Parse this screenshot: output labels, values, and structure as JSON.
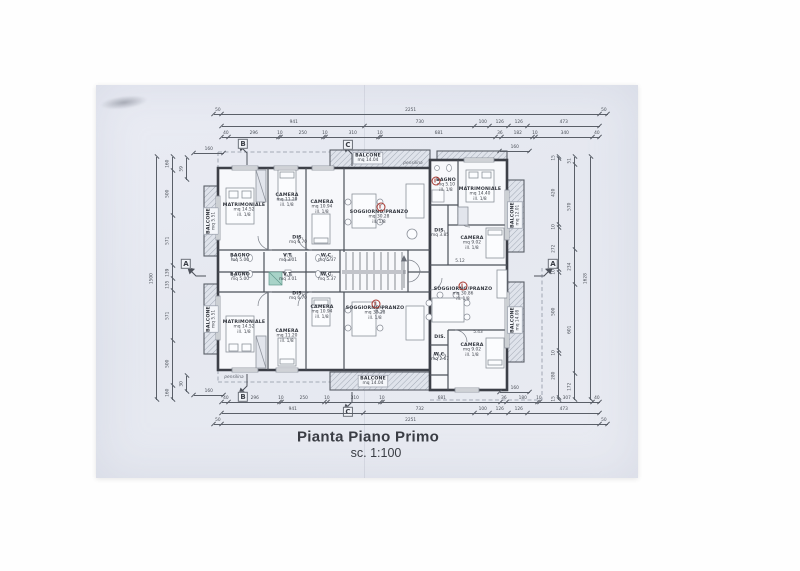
{
  "title": {
    "main": "Pianta Piano Primo",
    "scale": "sc. 1:100"
  },
  "sections": {
    "a": "A",
    "b": "B",
    "c": "C"
  },
  "annotations": {
    "pensilina": "pensilina"
  },
  "colors": {
    "marker_red": "#a93830",
    "shower_teal": "#79b5a8",
    "paper": "#e8eaf2",
    "line": "#4d515a"
  },
  "rooms": [
    {
      "n": "MATRIMONIALE",
      "a": "mq 14.52",
      "i": "ill. 1/8"
    },
    {
      "n": "CAMERA",
      "a": "mq 11.20",
      "i": "ill. 1/8"
    },
    {
      "n": "CAMERA",
      "a": "mq 10.94",
      "i": "ill. 1/8"
    },
    {
      "n": "SOGGIORNO/PRANZO",
      "a": "mq 30.28",
      "i": "ill. 1/8"
    },
    {
      "n": "DIS.",
      "a": "mq 6.70"
    },
    {
      "n": "BAGNO",
      "a": "mq 5.00"
    },
    {
      "n": "V.T.",
      "a": "mq 3.01"
    },
    {
      "n": "W.C.",
      "a": "mq 5.37",
      "i": "ill. 1/8"
    },
    {
      "n": "BAGNO",
      "a": "mq 5.00"
    },
    {
      "n": "V.T.",
      "a": "mq 3.01"
    },
    {
      "n": "W.C.",
      "a": "mq 5.37",
      "i": "ill. 1/8"
    },
    {
      "n": "DIS.",
      "a": "mq 6.70"
    },
    {
      "n": "MATRIMONIALE",
      "a": "mq 14.52",
      "i": "ill. 1/8"
    },
    {
      "n": "CAMERA",
      "a": "mq 11.20",
      "i": "ill. 1/8"
    },
    {
      "n": "CAMERA",
      "a": "mq 10.94",
      "i": "ill. 1/8"
    },
    {
      "n": "SOGGIORNO/PRANZO",
      "a": "mq 30.28",
      "i": "ill. 1/8"
    },
    {
      "n": "BAGNO",
      "a": "mq 5.10",
      "i": "ill. 1/8"
    },
    {
      "n": "MATRIMONIALE",
      "a": "mq 14.40",
      "i": "ill. 1/8"
    },
    {
      "n": "DIS.",
      "a": "mq 3.85"
    },
    {
      "n": "CAMERA",
      "a": "mq 9.02",
      "i": "ill. 1/8"
    },
    {
      "n": "SOGGIORNO/PRANZO",
      "a": "mq 30.86",
      "i": "ill. 1/8"
    },
    {
      "n": "DIS."
    },
    {
      "n": "W.C.",
      "a": "mq 2.67"
    },
    {
      "n": "CAMERA",
      "a": "mq 9.02",
      "i": "ill. 1/8"
    },
    {
      "n": "BALCONE",
      "a": "mq 5.51"
    },
    {
      "n": "BALCONE",
      "a": "mq 5.51"
    },
    {
      "n": "BALCONE",
      "a": "mq 14.04"
    },
    {
      "n": "BALCONE",
      "a": "mq 14.04"
    },
    {
      "n": "BALCONE",
      "a": "mq 12.01"
    },
    {
      "n": "BALCONE",
      "a": "mq 14.08"
    }
  ],
  "micro": {
    "d1": "5.12",
    "d2": "5.43"
  },
  "dims": {
    "top_outer": [
      "50",
      "2251",
      "50"
    ],
    "top_mid": [
      "941",
      "730",
      "100",
      "126",
      "126",
      "473"
    ],
    "top_inner": [
      "40",
      "296",
      "10",
      "250",
      "10",
      "310",
      "10",
      "681",
      "36",
      "182",
      "10",
      "340",
      "40"
    ],
    "bottom_inner": [
      "40",
      "296",
      "10",
      "250",
      "10",
      "310",
      "10",
      "681",
      "36",
      "180",
      "10",
      "307",
      "40"
    ],
    "bottom_mid": [
      "941",
      "732",
      "100",
      "126",
      "126",
      "473"
    ],
    "bottom_outer": [
      "50",
      "2251",
      "50"
    ],
    "left_outer": [
      "1500"
    ],
    "left_inner": [
      "160",
      "500",
      "571",
      "139",
      "135",
      "571",
      "500",
      "160"
    ],
    "right_inner": [
      "15",
      "420",
      "10",
      "272",
      "10",
      "500",
      "10",
      "280",
      "15"
    ],
    "right_mid": [
      "51",
      "570",
      "234",
      "601",
      "172"
    ],
    "right_outer": [
      "1628"
    ],
    "corner_tl": [
      "160"
    ],
    "corner_tr": [
      "160"
    ],
    "corner_bl": [
      "160"
    ],
    "corner_br": [
      "160"
    ],
    "side_tl": [
      "59"
    ],
    "side_bl": [
      "30"
    ]
  }
}
